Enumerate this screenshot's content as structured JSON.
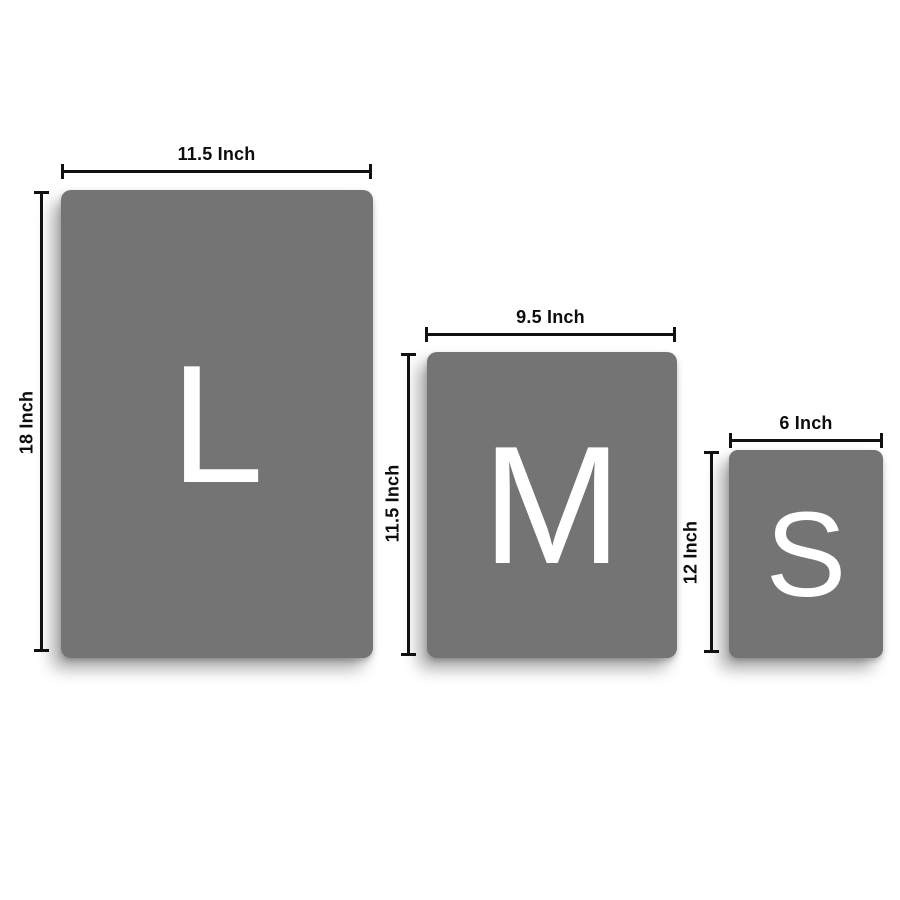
{
  "page": {
    "background": "#ffffff",
    "description": "Size comparison diagram of three gray panels labeled L, M and S with inch dimension callouts"
  },
  "colors": {
    "panel_fill": "#747474",
    "letter_color": "#ffffff",
    "dimension_line_color": "#111111",
    "dimension_label_color": "#0d0d0d"
  },
  "sizes": [
    {
      "code": "L",
      "name": "large",
      "width_label": "11.5 Inch",
      "height_label": "18 Inch"
    },
    {
      "code": "M",
      "name": "medium",
      "width_label": "9.5 Inch",
      "height_label": "11.5 Inch"
    },
    {
      "code": "S",
      "name": "small",
      "width_label": "6 Inch",
      "height_label": "12 Inch"
    }
  ]
}
